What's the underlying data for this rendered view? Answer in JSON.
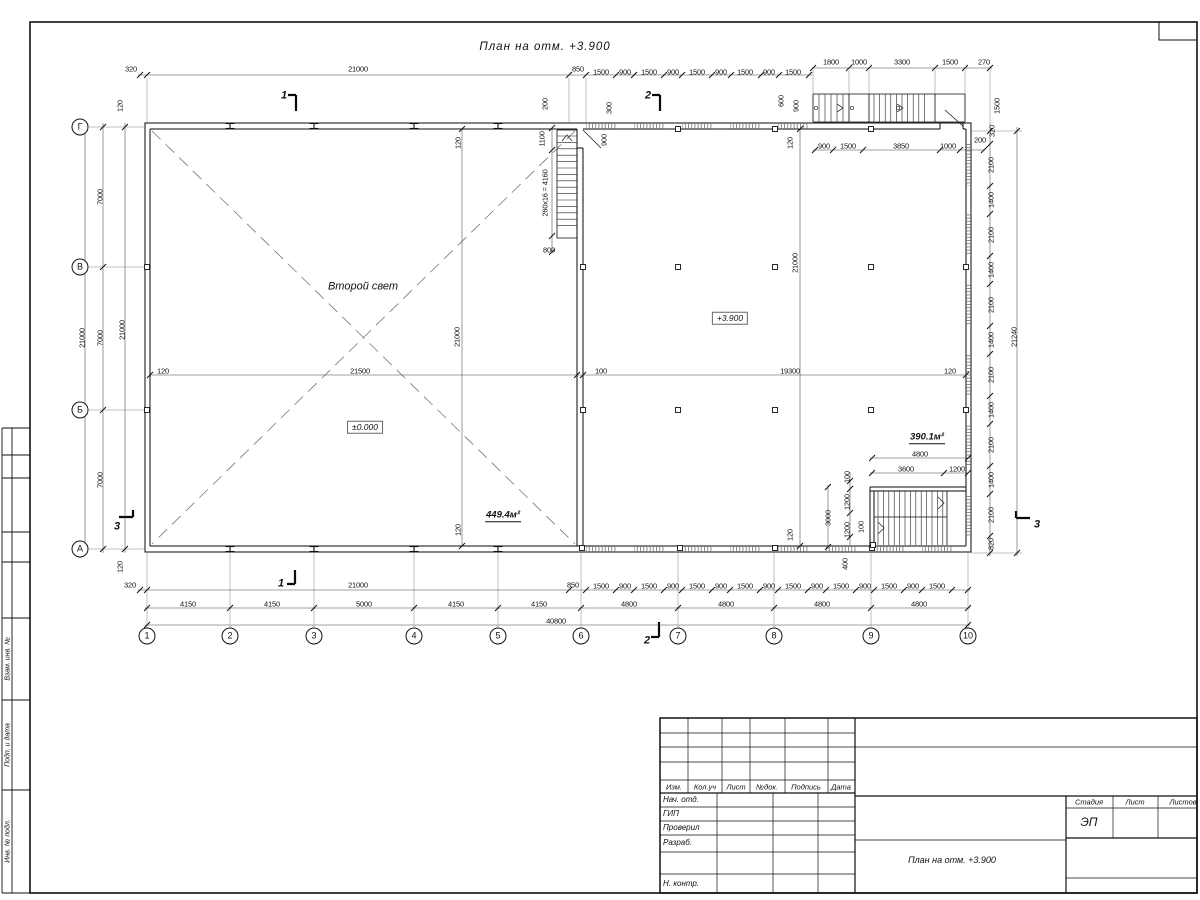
{
  "titles": {
    "plan": "План на отм. +3.900",
    "stamp": "План на отм. +3.900"
  },
  "title_block": {
    "stage_value": "ЭП"
  },
  "labels": [
    {
      "n": "dim",
      "t": "320",
      "x": 131,
      "y": 69,
      "c": "d"
    },
    {
      "n": "dim",
      "t": "21000",
      "x": 358,
      "y": 69,
      "c": "d"
    },
    {
      "n": "dim",
      "t": "850",
      "x": 578,
      "y": 69,
      "c": "d"
    },
    {
      "n": "dim",
      "t": "1500",
      "x": 601,
      "y": 72,
      "c": "d"
    },
    {
      "n": "dim",
      "t": "900",
      "x": 625,
      "y": 72,
      "c": "d"
    },
    {
      "n": "dim",
      "t": "1500",
      "x": 649,
      "y": 72,
      "c": "d"
    },
    {
      "n": "dim",
      "t": "900",
      "x": 673,
      "y": 72,
      "c": "d"
    },
    {
      "n": "dim",
      "t": "1500",
      "x": 697,
      "y": 72,
      "c": "d"
    },
    {
      "n": "dim",
      "t": "900",
      "x": 721,
      "y": 72,
      "c": "d"
    },
    {
      "n": "dim",
      "t": "1500",
      "x": 745,
      "y": 72,
      "c": "d"
    },
    {
      "n": "dim",
      "t": "900",
      "x": 769,
      "y": 72,
      "c": "d"
    },
    {
      "n": "dim",
      "t": "1500",
      "x": 793,
      "y": 72,
      "c": "d"
    },
    {
      "n": "dim",
      "t": "1800",
      "x": 831,
      "y": 62,
      "c": "d"
    },
    {
      "n": "dim",
      "t": "1000",
      "x": 859,
      "y": 62,
      "c": "d"
    },
    {
      "n": "dim",
      "t": "3300",
      "x": 902,
      "y": 62,
      "c": "d"
    },
    {
      "n": "dim",
      "t": "1500",
      "x": 950,
      "y": 62,
      "c": "d"
    },
    {
      "n": "dim",
      "t": "270",
      "x": 984,
      "y": 62,
      "c": "d"
    },
    {
      "n": "dim",
      "t": "600",
      "x": 781,
      "y": 101,
      "c": "dv"
    },
    {
      "n": "dim",
      "t": "900",
      "x": 796,
      "y": 106,
      "c": "dv"
    },
    {
      "n": "dim",
      "t": "1500",
      "x": 997,
      "y": 106,
      "c": "dv"
    },
    {
      "n": "dim",
      "t": "320",
      "x": 992,
      "y": 131,
      "c": "dv"
    },
    {
      "n": "dim",
      "t": "200",
      "x": 980,
      "y": 140,
      "c": "d"
    },
    {
      "n": "dim",
      "t": "900",
      "x": 824,
      "y": 146,
      "c": "d"
    },
    {
      "n": "dim",
      "t": "1500",
      "x": 848,
      "y": 146,
      "c": "d"
    },
    {
      "n": "dim",
      "t": "3850",
      "x": 901,
      "y": 146,
      "c": "d"
    },
    {
      "n": "dim",
      "t": "1000",
      "x": 948,
      "y": 146,
      "c": "d"
    },
    {
      "n": "dim",
      "t": "120",
      "x": 790,
      "y": 143,
      "c": "dv"
    },
    {
      "n": "dim",
      "t": "200",
      "x": 545,
      "y": 104,
      "c": "dv"
    },
    {
      "n": "dim",
      "t": "300",
      "x": 609,
      "y": 108,
      "c": "dv"
    },
    {
      "n": "dim",
      "t": "900",
      "x": 604,
      "y": 140,
      "c": "dv"
    },
    {
      "n": "dim",
      "t": "1100",
      "x": 542,
      "y": 139,
      "c": "dv"
    },
    {
      "n": "stair-note",
      "t": "260x16 = 4160",
      "x": 545,
      "y": 193,
      "c": "dv"
    },
    {
      "n": "dim",
      "t": "800",
      "x": 549,
      "y": 250,
      "c": "d"
    },
    {
      "n": "dim",
      "t": "120",
      "x": 458,
      "y": 143,
      "c": "dv"
    },
    {
      "n": "dim",
      "t": "120",
      "x": 458,
      "y": 530,
      "c": "dv"
    },
    {
      "n": "dim",
      "t": "120",
      "x": 790,
      "y": 535,
      "c": "dv"
    },
    {
      "n": "dim",
      "t": "120",
      "x": 120,
      "y": 106,
      "c": "dv"
    },
    {
      "n": "dim",
      "t": "7000",
      "x": 100,
      "y": 197,
      "c": "dv"
    },
    {
      "n": "dim",
      "t": "7000",
      "x": 100,
      "y": 338,
      "c": "dv"
    },
    {
      "n": "dim",
      "t": "7000",
      "x": 100,
      "y": 480,
      "c": "dv"
    },
    {
      "n": "dim",
      "t": "120",
      "x": 120,
      "y": 567,
      "c": "dv"
    },
    {
      "n": "dim",
      "t": "21000",
      "x": 82,
      "y": 338,
      "c": "dv"
    },
    {
      "n": "dim",
      "t": "21000",
      "x": 122,
      "y": 330,
      "c": "dv"
    },
    {
      "n": "dim",
      "t": "2100",
      "x": 991,
      "y": 165,
      "c": "dv"
    },
    {
      "n": "dim",
      "t": "1400",
      "x": 991,
      "y": 200,
      "c": "dv"
    },
    {
      "n": "dim",
      "t": "2100",
      "x": 991,
      "y": 235,
      "c": "dv"
    },
    {
      "n": "dim",
      "t": "1400",
      "x": 991,
      "y": 270,
      "c": "dv"
    },
    {
      "n": "dim",
      "t": "2100",
      "x": 991,
      "y": 305,
      "c": "dv"
    },
    {
      "n": "dim",
      "t": "1400",
      "x": 991,
      "y": 340,
      "c": "dv"
    },
    {
      "n": "dim",
      "t": "2100",
      "x": 991,
      "y": 375,
      "c": "dv"
    },
    {
      "n": "dim",
      "t": "1400",
      "x": 991,
      "y": 410,
      "c": "dv"
    },
    {
      "n": "dim",
      "t": "2100",
      "x": 991,
      "y": 445,
      "c": "dv"
    },
    {
      "n": "dim",
      "t": "1400",
      "x": 991,
      "y": 480,
      "c": "dv"
    },
    {
      "n": "dim",
      "t": "2100",
      "x": 991,
      "y": 515,
      "c": "dv"
    },
    {
      "n": "dim",
      "t": "820",
      "x": 991,
      "y": 544,
      "c": "dv"
    },
    {
      "n": "dim",
      "t": "21240",
      "x": 1014,
      "y": 337,
      "c": "dv"
    },
    {
      "n": "dim",
      "t": "120",
      "x": 163,
      "y": 371,
      "c": "d"
    },
    {
      "n": "dim",
      "t": "21500",
      "x": 360,
      "y": 371,
      "c": "d"
    },
    {
      "n": "dim",
      "t": "100",
      "x": 601,
      "y": 371,
      "c": "d"
    },
    {
      "n": "dim",
      "t": "19300",
      "x": 790,
      "y": 371,
      "c": "d"
    },
    {
      "n": "dim",
      "t": "120",
      "x": 950,
      "y": 371,
      "c": "d"
    },
    {
      "n": "dim",
      "t": "21000",
      "x": 457,
      "y": 337,
      "c": "dv"
    },
    {
      "n": "dim",
      "t": "21000",
      "x": 795,
      "y": 263,
      "c": "dv"
    },
    {
      "n": "area-label",
      "t": "390.1м²",
      "x": 927,
      "y": 438,
      "c": "area"
    },
    {
      "n": "dim",
      "t": "4800",
      "x": 920,
      "y": 454,
      "c": "d"
    },
    {
      "n": "dim",
      "t": "3600",
      "x": 906,
      "y": 469,
      "c": "d"
    },
    {
      "n": "dim",
      "t": "1200",
      "x": 957,
      "y": 469,
      "c": "d"
    },
    {
      "n": "dim",
      "t": "100",
      "x": 847,
      "y": 477,
      "c": "dv"
    },
    {
      "n": "dim",
      "t": "1200",
      "x": 847,
      "y": 502,
      "c": "dv"
    },
    {
      "n": "dim",
      "t": "1200",
      "x": 847,
      "y": 530,
      "c": "dv"
    },
    {
      "n": "dim",
      "t": "100",
      "x": 861,
      "y": 527,
      "c": "dv"
    },
    {
      "n": "dim",
      "t": "3000",
      "x": 828,
      "y": 518,
      "c": "dv"
    },
    {
      "n": "dim",
      "t": "400",
      "x": 845,
      "y": 564,
      "c": "dv"
    },
    {
      "n": "dim",
      "t": "320",
      "x": 130,
      "y": 585,
      "c": "d"
    },
    {
      "n": "dim",
      "t": "21000",
      "x": 358,
      "y": 585,
      "c": "d"
    },
    {
      "n": "dim",
      "t": "850",
      "x": 573,
      "y": 585,
      "c": "d"
    },
    {
      "n": "dim",
      "t": "1500",
      "x": 601,
      "y": 586,
      "c": "d"
    },
    {
      "n": "dim",
      "t": "900",
      "x": 625,
      "y": 586,
      "c": "d"
    },
    {
      "n": "dim",
      "t": "1500",
      "x": 649,
      "y": 586,
      "c": "d"
    },
    {
      "n": "dim",
      "t": "900",
      "x": 673,
      "y": 586,
      "c": "d"
    },
    {
      "n": "dim",
      "t": "1500",
      "x": 697,
      "y": 586,
      "c": "d"
    },
    {
      "n": "dim",
      "t": "900",
      "x": 721,
      "y": 586,
      "c": "d"
    },
    {
      "n": "dim",
      "t": "1500",
      "x": 745,
      "y": 586,
      "c": "d"
    },
    {
      "n": "dim",
      "t": "900",
      "x": 769,
      "y": 586,
      "c": "d"
    },
    {
      "n": "dim",
      "t": "1500",
      "x": 793,
      "y": 586,
      "c": "d"
    },
    {
      "n": "dim",
      "t": "900",
      "x": 817,
      "y": 586,
      "c": "d"
    },
    {
      "n": "dim",
      "t": "1500",
      "x": 841,
      "y": 586,
      "c": "d"
    },
    {
      "n": "dim",
      "t": "900",
      "x": 865,
      "y": 586,
      "c": "d"
    },
    {
      "n": "dim",
      "t": "1500",
      "x": 889,
      "y": 586,
      "c": "d"
    },
    {
      "n": "dim",
      "t": "900",
      "x": 913,
      "y": 586,
      "c": "d"
    },
    {
      "n": "dim",
      "t": "1500",
      "x": 937,
      "y": 586,
      "c": "d"
    },
    {
      "n": "dim",
      "t": "4150",
      "x": 188,
      "y": 604,
      "c": "d"
    },
    {
      "n": "dim",
      "t": "4150",
      "x": 272,
      "y": 604,
      "c": "d"
    },
    {
      "n": "dim",
      "t": "5000",
      "x": 364,
      "y": 604,
      "c": "d"
    },
    {
      "n": "dim",
      "t": "4150",
      "x": 456,
      "y": 604,
      "c": "d"
    },
    {
      "n": "dim",
      "t": "4150",
      "x": 539,
      "y": 604,
      "c": "d"
    },
    {
      "n": "dim",
      "t": "4800",
      "x": 629,
      "y": 604,
      "c": "d"
    },
    {
      "n": "dim",
      "t": "4800",
      "x": 726,
      "y": 604,
      "c": "d"
    },
    {
      "n": "dim",
      "t": "4800",
      "x": 822,
      "y": 604,
      "c": "d"
    },
    {
      "n": "dim",
      "t": "4800",
      "x": 919,
      "y": 604,
      "c": "d"
    },
    {
      "n": "dim",
      "t": "40800",
      "x": 556,
      "y": 621,
      "c": "d"
    },
    {
      "n": "room-label",
      "t": "Второй свет",
      "x": 363,
      "y": 287,
      "c": "room"
    },
    {
      "n": "level-mark",
      "t": "+3.900",
      "x": 730,
      "y": 318,
      "c": "lvl"
    },
    {
      "n": "level-mark",
      "t": "±0.000",
      "x": 365,
      "y": 427,
      "c": "lvl"
    },
    {
      "n": "area-label",
      "t": "449.4м²",
      "x": 503,
      "y": 516,
      "c": "area"
    },
    {
      "n": "section-mark",
      "t": "1",
      "x": 284,
      "y": 96,
      "c": "sec"
    },
    {
      "n": "section-mark",
      "t": "1",
      "x": 281,
      "y": 584,
      "c": "sec"
    },
    {
      "n": "section-mark",
      "t": "2",
      "x": 648,
      "y": 96,
      "c": "sec"
    },
    {
      "n": "section-mark",
      "t": "2",
      "x": 647,
      "y": 641,
      "c": "sec"
    },
    {
      "n": "section-mark",
      "t": "3",
      "x": 117,
      "y": 527,
      "c": "sec"
    },
    {
      "n": "section-mark",
      "t": "3",
      "x": 1037,
      "y": 525,
      "c": "sec"
    },
    {
      "n": "axis-bubble",
      "t": "1",
      "x": 147,
      "y": 636,
      "c": "ab"
    },
    {
      "n": "axis-bubble",
      "t": "2",
      "x": 230,
      "y": 636,
      "c": "ab"
    },
    {
      "n": "axis-bubble",
      "t": "3",
      "x": 314,
      "y": 636,
      "c": "ab"
    },
    {
      "n": "axis-bubble",
      "t": "4",
      "x": 414,
      "y": 636,
      "c": "ab"
    },
    {
      "n": "axis-bubble",
      "t": "5",
      "x": 498,
      "y": 636,
      "c": "ab"
    },
    {
      "n": "axis-bubble",
      "t": "6",
      "x": 581,
      "y": 636,
      "c": "ab"
    },
    {
      "n": "axis-bubble",
      "t": "7",
      "x": 678,
      "y": 636,
      "c": "ab"
    },
    {
      "n": "axis-bubble",
      "t": "8",
      "x": 774,
      "y": 636,
      "c": "ab"
    },
    {
      "n": "axis-bubble",
      "t": "9",
      "x": 871,
      "y": 636,
      "c": "ab"
    },
    {
      "n": "axis-bubble",
      "t": "10",
      "x": 968,
      "y": 636,
      "c": "ab"
    },
    {
      "n": "axis-bubble",
      "t": "Г",
      "x": 80,
      "y": 127,
      "c": "ab"
    },
    {
      "n": "axis-bubble",
      "t": "В",
      "x": 80,
      "y": 267,
      "c": "ab"
    },
    {
      "n": "axis-bubble",
      "t": "Б",
      "x": 80,
      "y": 410,
      "c": "ab"
    },
    {
      "n": "axis-bubble",
      "t": "А",
      "x": 80,
      "y": 549,
      "c": "ab"
    },
    {
      "n": "tb-col-izm",
      "t": "Изм.",
      "x": 674,
      "y": 787,
      "c": "th"
    },
    {
      "n": "tb-col-koluch",
      "t": "Кол.уч",
      "x": 705,
      "y": 787,
      "c": "th"
    },
    {
      "n": "tb-col-list",
      "t": "Лист",
      "x": 736,
      "y": 787,
      "c": "th"
    },
    {
      "n": "tb-col-ndok",
      "t": "№док.",
      "x": 767,
      "y": 787,
      "c": "th"
    },
    {
      "n": "tb-col-podpis",
      "t": "Подпись",
      "x": 806,
      "y": 787,
      "c": "th"
    },
    {
      "n": "tb-col-data",
      "t": "Дата",
      "x": 841,
      "y": 787,
      "c": "th"
    },
    {
      "n": "tb-row-nachotd",
      "t": "Нач. отд.",
      "x": 663,
      "y": 800,
      "c": "tn"
    },
    {
      "n": "tb-row-gip",
      "t": "ГИП",
      "x": 663,
      "y": 814,
      "c": "tn"
    },
    {
      "n": "tb-row-proveril",
      "t": "Проверил",
      "x": 663,
      "y": 828,
      "c": "tn"
    },
    {
      "n": "tb-row-razrab",
      "t": "Разраб.",
      "x": 663,
      "y": 843,
      "c": "tn"
    },
    {
      "n": "tb-row-nkontr",
      "t": "Н. контр.",
      "x": 663,
      "y": 884,
      "c": "tn"
    },
    {
      "n": "tb-stadia-header",
      "t": "Стадия",
      "x": 1089,
      "y": 802,
      "c": "th"
    },
    {
      "n": "tb-list-header",
      "t": "Лист",
      "x": 1135,
      "y": 802,
      "c": "th"
    },
    {
      "n": "tb-listov-header",
      "t": "Листов",
      "x": 1183,
      "y": 802,
      "c": "th"
    },
    {
      "n": "margin-label-vzam",
      "t": "Взам. инв. №",
      "x": 8,
      "y": 659,
      "c": "tr"
    },
    {
      "n": "margin-label-podp",
      "t": "Подп. и дата",
      "x": 8,
      "y": 745,
      "c": "tr"
    },
    {
      "n": "margin-label-inv",
      "t": "Инв. № подл.",
      "x": 8,
      "y": 841,
      "c": "tr"
    }
  ]
}
